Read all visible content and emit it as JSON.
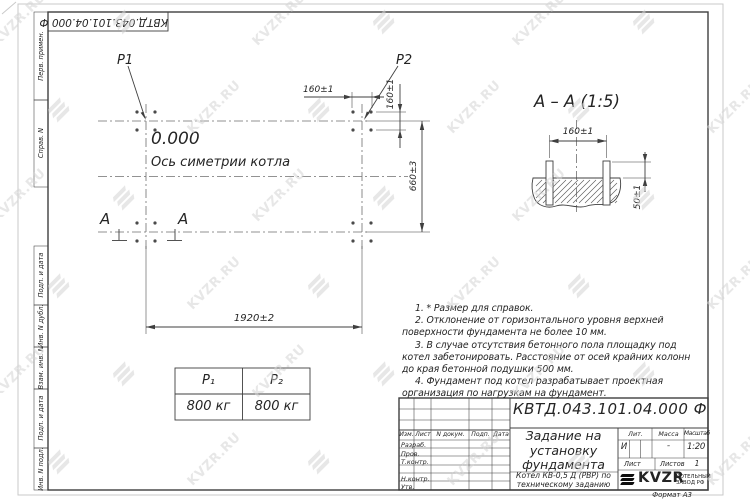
{
  "watermark": {
    "text": "KVZR.RU"
  },
  "margin": {
    "designation_top": "КВТД.043.101.04.000 Ф",
    "labels": [
      "Перв. примен.",
      "Справ. N",
      "Подп. и дата",
      "Инв. N дубл.",
      "Взам. инв. N",
      "Подп. и дата",
      "Инв. N подл."
    ]
  },
  "plan": {
    "p1_label": "P1",
    "p2_label": "P2",
    "elevation": "0.000",
    "axis_label": "Ось симетрии котла",
    "dim_bolt_spacing_top": "160±1",
    "dim_bolt_spacing_side": "160±1",
    "dim_width": "660±3",
    "dim_length": "1920±2",
    "section_letter": "А"
  },
  "section": {
    "title": "А – А (1:5)",
    "dim_spacing": "160±1",
    "dim_height": "50±1"
  },
  "notes": {
    "items": [
      "1. * Размер для справок.",
      "2. Отклонение от горизонтального уровня верхней поверхности фундамента не более 10 мм.",
      "3. В случае отсутствия бетонного пола площадку под котел забетонировать. Расстояние от осей крайних колонн до края бетонной подушки 500 мм.",
      "4. Фундамент под котел разрабатывает проектная организация по нагрузкам на фундамент."
    ]
  },
  "load_table": {
    "headers": [
      "P₁",
      "P₂"
    ],
    "values": [
      "800 кг",
      "800 кг"
    ]
  },
  "title_block": {
    "designation": "КВТД.043.101.04.000 Ф",
    "doc_title": "Задание на установку фундамента",
    "product": "Котел КВ-0,5 Д (РВР) по техническому заданию",
    "header_cols": [
      "Изм.",
      "Лист",
      "N докум.",
      "Подп.",
      "Дата"
    ],
    "sign_rows": [
      "Разраб.",
      "Пров.",
      "Т.контр.",
      "Н.контр.",
      "Утв."
    ],
    "lit_label": "Лит.",
    "lit_value": "И",
    "mass_label": "Масса",
    "mass_value": "-",
    "scale_label": "Масштаб",
    "scale_value": "1:20",
    "sheet_label": "Лист",
    "sheets_label": "Листов",
    "sheets_value": "1",
    "company_name": "KVZR",
    "company_caption": "КОТЕЛЬНЫЙ ЗАВОД РФ",
    "format_label": "Формат А3"
  }
}
